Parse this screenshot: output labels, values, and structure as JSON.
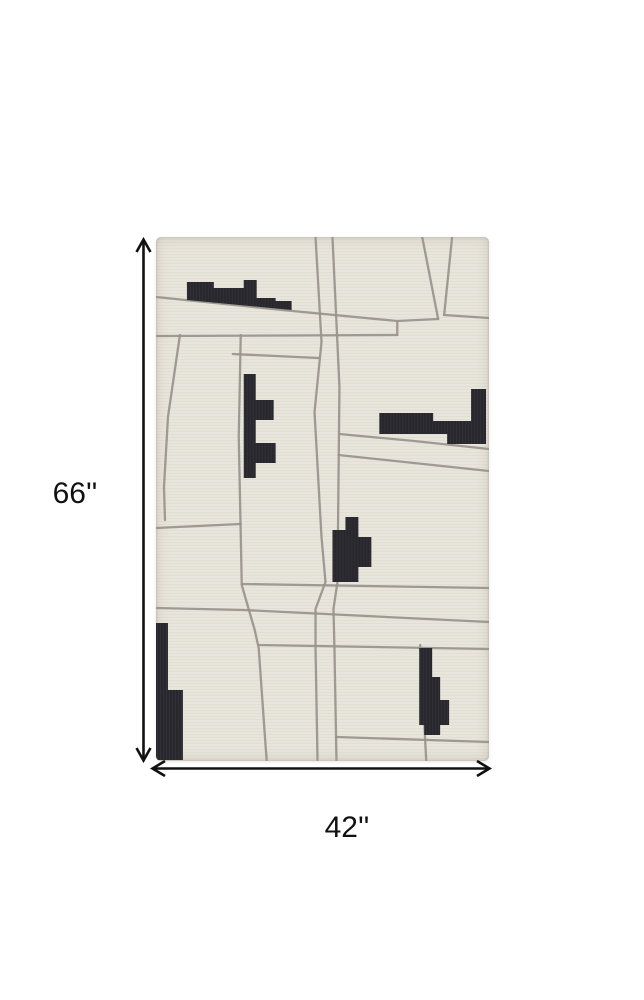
{
  "diagram": {
    "type": "rug-product-dimension-diagram",
    "height_label": "66''",
    "width_label": "42''"
  },
  "colors": {
    "background": "#ffffff",
    "rug_base": "#e8e5dc",
    "rug_stripe": "#e1ded4",
    "street_gray": "#97948b",
    "block_black": "#27272d",
    "block_rib": "#3a3a42",
    "dimension": "#111111"
  },
  "rug": {
    "canvas": {
      "width": 334,
      "height": 524
    },
    "streets": [
      {
        "id": "street-top-diagonal",
        "points": [
          [
            0,
            60
          ],
          [
            137,
            74
          ],
          [
            242,
            84
          ],
          [
            283,
            82
          ]
        ]
      },
      {
        "id": "street-upper-horizontal",
        "points": [
          [
            0,
            99
          ],
          [
            242,
            98
          ]
        ]
      },
      {
        "id": "street-upper-connector",
        "points": [
          [
            242,
            84
          ],
          [
            242,
            98
          ]
        ]
      },
      {
        "id": "street-topright-slant-left",
        "points": [
          [
            267,
            0
          ],
          [
            283,
            82
          ]
        ]
      },
      {
        "id": "street-topright-slant-right",
        "points": [
          [
            297,
            0
          ],
          [
            289,
            78
          ]
        ]
      },
      {
        "id": "street-topright-stub",
        "points": [
          [
            289,
            78
          ],
          [
            334,
            81
          ]
        ]
      },
      {
        "id": "street-short-horizontal",
        "points": [
          [
            77,
            117
          ],
          [
            163,
            121
          ]
        ]
      },
      {
        "id": "street-left-vertical",
        "points": [
          [
            85,
            98
          ],
          [
            83,
            200
          ],
          [
            86,
            347
          ]
        ]
      },
      {
        "id": "street-far-left-diagonal",
        "points": [
          [
            24,
            98
          ],
          [
            12,
            180
          ],
          [
            8,
            250
          ],
          [
            9,
            283
          ]
        ]
      },
      {
        "id": "street-left-horizontal",
        "points": [
          [
            0,
            291
          ],
          [
            85,
            287
          ]
        ]
      },
      {
        "id": "street-center-vertical-a",
        "points": [
          [
            160,
            0
          ],
          [
            166,
            105
          ],
          [
            159,
            175
          ],
          [
            166,
            300
          ],
          [
            170,
            345
          ],
          [
            160,
            372
          ],
          [
            160,
            410
          ],
          [
            162,
            523
          ]
        ]
      },
      {
        "id": "street-center-vertical-b",
        "points": [
          [
            177,
            0
          ],
          [
            184,
            150
          ],
          [
            182,
            345
          ],
          [
            178,
            372
          ],
          [
            179,
            412
          ],
          [
            181,
            523
          ]
        ]
      },
      {
        "id": "street-right-diagonal-a",
        "points": [
          [
            184,
            197
          ],
          [
            259,
            204
          ],
          [
            334,
            212
          ]
        ]
      },
      {
        "id": "street-right-diagonal-b",
        "points": [
          [
            183,
            218
          ],
          [
            334,
            234
          ]
        ]
      },
      {
        "id": "street-mid-horizontal-a",
        "points": [
          [
            86,
            347
          ],
          [
            334,
            351
          ]
        ]
      },
      {
        "id": "street-mid-horizontal-b",
        "points": [
          [
            0,
            371
          ],
          [
            88,
            373
          ],
          [
            334,
            385
          ]
        ]
      },
      {
        "id": "street-lower-diagonal",
        "points": [
          [
            86,
            348
          ],
          [
            99,
            393
          ],
          [
            103,
            411
          ],
          [
            110,
            510
          ],
          [
            111,
            523
          ]
        ]
      },
      {
        "id": "street-lower-horizontal",
        "points": [
          [
            103,
            408
          ],
          [
            334,
            412
          ]
        ]
      },
      {
        "id": "street-bottomright-vertical",
        "points": [
          [
            265,
            408
          ],
          [
            271,
            523
          ]
        ]
      },
      {
        "id": "street-bottom-horizontal",
        "points": [
          [
            181,
            500
          ],
          [
            334,
            505
          ]
        ]
      }
    ],
    "blocks": [
      {
        "id": "block-top-left",
        "points": [
          [
            31,
            45
          ],
          [
            58,
            45
          ],
          [
            58,
            51
          ],
          [
            88,
            51
          ],
          [
            88,
            43
          ],
          [
            101,
            43
          ],
          [
            101,
            61
          ],
          [
            120,
            61
          ],
          [
            120,
            64
          ],
          [
            136,
            64
          ],
          [
            136,
            73
          ],
          [
            31,
            63
          ]
        ]
      },
      {
        "id": "block-mid-left",
        "points": [
          [
            88,
            137
          ],
          [
            100,
            137
          ],
          [
            100,
            163
          ],
          [
            118,
            163
          ],
          [
            118,
            183
          ],
          [
            100,
            183
          ],
          [
            100,
            206
          ],
          [
            120,
            206
          ],
          [
            120,
            226
          ],
          [
            100,
            226
          ],
          [
            100,
            241
          ],
          [
            88,
            241
          ]
        ]
      },
      {
        "id": "block-mid-right",
        "points": [
          [
            224,
            176
          ],
          [
            278,
            176
          ],
          [
            278,
            184
          ],
          [
            316,
            184
          ],
          [
            316,
            152
          ],
          [
            331,
            152
          ],
          [
            331,
            207
          ],
          [
            292,
            207
          ],
          [
            292,
            197
          ],
          [
            224,
            197
          ]
        ]
      },
      {
        "id": "block-center",
        "points": [
          [
            190,
            280
          ],
          [
            203,
            280
          ],
          [
            203,
            300
          ],
          [
            216,
            300
          ],
          [
            216,
            330
          ],
          [
            203,
            330
          ],
          [
            203,
            345
          ],
          [
            177,
            345
          ],
          [
            177,
            293
          ],
          [
            190,
            293
          ]
        ]
      },
      {
        "id": "block-bottom-left",
        "points": [
          [
            0,
            386
          ],
          [
            12,
            386
          ],
          [
            12,
            453
          ],
          [
            27,
            453
          ],
          [
            27,
            523
          ],
          [
            0,
            523
          ]
        ]
      },
      {
        "id": "block-bottom-right",
        "points": [
          [
            264,
            411
          ],
          [
            277,
            411
          ],
          [
            277,
            440
          ],
          [
            285,
            440
          ],
          [
            285,
            463
          ],
          [
            294,
            463
          ],
          [
            294,
            488
          ],
          [
            285,
            488
          ],
          [
            285,
            498
          ],
          [
            269,
            498
          ],
          [
            269,
            488
          ],
          [
            264,
            488
          ]
        ]
      }
    ]
  }
}
